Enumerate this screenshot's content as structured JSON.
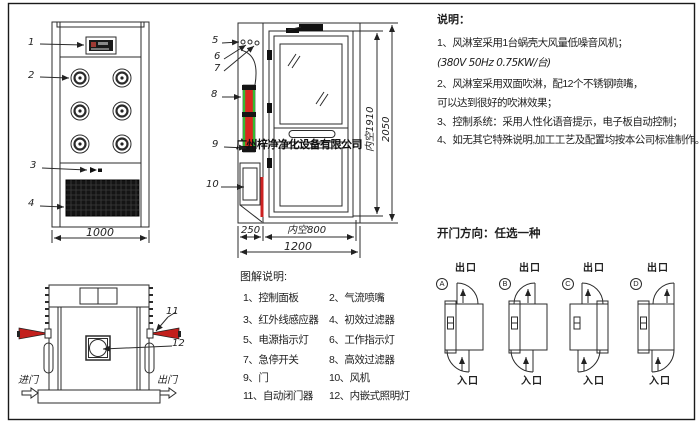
{
  "watermark": "广州梓净净化设备有限公司",
  "front_view": {
    "callouts": [
      "1",
      "2",
      "3",
      "4"
    ],
    "dim_width": "1000"
  },
  "side_view": {
    "callouts": [
      "5",
      "6",
      "7",
      "8",
      "9",
      "10"
    ],
    "dims": {
      "left": "250",
      "inner_width": "内空800",
      "total_width": "1200",
      "inner_height": "内空1910",
      "total_height": "2050"
    }
  },
  "top_view": {
    "callouts": [
      "11",
      "12"
    ],
    "enter": "进门",
    "exit": "出门"
  },
  "notes": {
    "title": "说明：",
    "lines": [
      "1、风淋室采用1台蜗壳大风量低噪音风机；",
      "(380V  50Hz  0.75KW/台)",
      "2、风淋室采用双面吹淋，配12个不锈钢喷嘴，",
      "可以达到很好的吹淋效果；",
      "3、控制系统：采用人性化语音提示，电子板自动控制；",
      "4、如无其它特殊说明,加工工艺及配置均按本公司标准制作。"
    ]
  },
  "door_direction": {
    "title": "开门方向：任选一种",
    "exit_label": "出口",
    "enter_label": "入口",
    "options": [
      {
        "letter": "A"
      },
      {
        "letter": "B"
      },
      {
        "letter": "C"
      },
      {
        "letter": "D"
      }
    ]
  },
  "legend": {
    "title": "图解说明:",
    "rows": [
      [
        "1、控制面板",
        "2、气流喷嘴"
      ],
      [
        "3、红外线感应器",
        "4、初效过滤器"
      ],
      [
        "5、电源指示灯",
        "6、工作指示灯"
      ],
      [
        "7、急停开关",
        "8、高效过滤器"
      ],
      [
        "9、门",
        "10、风机"
      ],
      [
        "11、自动闭门器",
        "12、内嵌式照明灯"
      ]
    ]
  },
  "colors": {
    "line": "#2b2b2b",
    "accent_red": "#d9291f",
    "accent_green": "#33bb33",
    "panel_dark": "#141414"
  }
}
